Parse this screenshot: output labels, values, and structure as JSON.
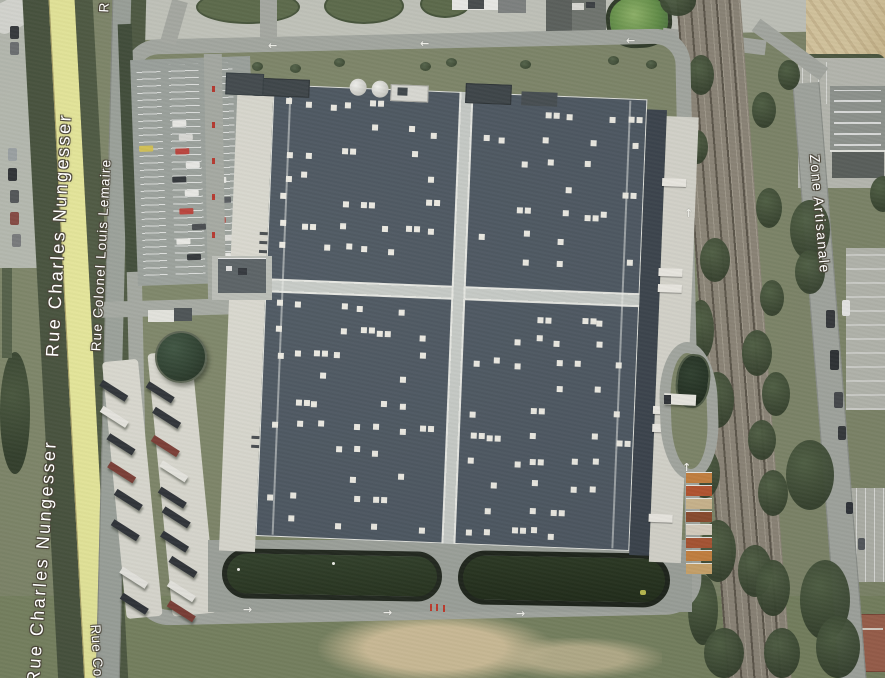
{
  "map": {
    "view": "satellite",
    "street_labels": [
      {
        "id": "rue-charles-nungesser-north",
        "text": "Rue Charles Nungesser",
        "orientation": "bottom-to-top"
      },
      {
        "id": "rue-charles-nungesser-south",
        "text": "Rue Charles Nungesser",
        "orientation": "bottom-to-top",
        "clipped": "first letters cut by bottom edge"
      },
      {
        "id": "rue-colonel-louis-lemaire",
        "text": "Rue Colonel Louis Lemaire",
        "orientation": "bottom-to-top"
      },
      {
        "id": "rue-partial-top",
        "text": "R",
        "orientation": "bottom-to-top",
        "clipped": "cut by top edge"
      },
      {
        "id": "rue-co-partial-bottom",
        "text": "Rue Co",
        "orientation": "top-to-bottom",
        "clipped": "continues past bottom edge"
      },
      {
        "id": "zone-artisanale",
        "text": "Zone Artisanale",
        "orientation": "top-to-bottom"
      }
    ],
    "label_style": {
      "text_color": "#ffffff",
      "outline_color": "#4a4438"
    },
    "road_markings": {
      "arrow_left": "←",
      "arrow_up": "↑",
      "arrow_right": "→"
    },
    "features": {
      "warehouse": {
        "description": "large logistics warehouse, four roof quadrants divided by light strips, scattered white skylights",
        "roof_color": "#4c5660",
        "skylight_color": "#ECEAE2",
        "skylights_per_quadrant": 34
      },
      "retention_basins": {
        "count": 2,
        "water_color": "#2c3a24"
      },
      "circular_pond": {
        "water_color": "#2e4133"
      },
      "green_pond_north": {
        "water_color": "#6f9b52"
      },
      "truck_parking": {
        "trailer_count": 18
      },
      "car_parking": {
        "car_count": 16
      },
      "railway": {
        "track_count": 4,
        "ballast_color": "#8c8577"
      },
      "roads": {
        "main_road_color": "#e5e699",
        "asphalt_color": "#a3a7a0"
      },
      "terrain": {
        "field_color": "#7d8568",
        "tree_color": "#42503a",
        "sand_color": "#d5c59c"
      }
    }
  }
}
